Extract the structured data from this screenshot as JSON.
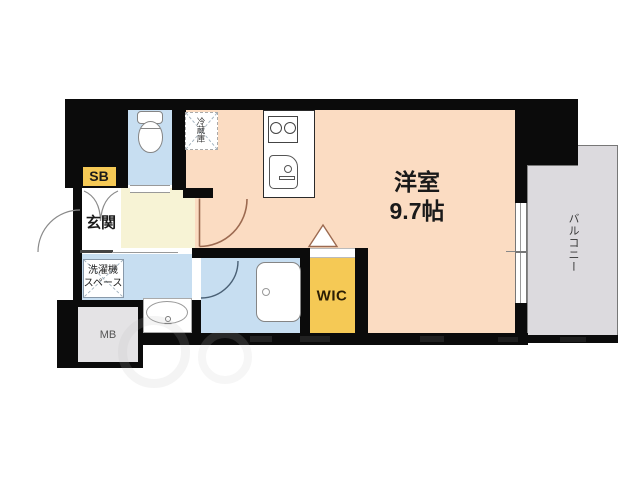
{
  "labels": {
    "main_room": {
      "name": "洋室",
      "size": "9.7帖"
    },
    "balcony": "バルコニー",
    "wic": "WIC",
    "genkan": "玄関",
    "shoe_box": "SB",
    "meter_box": "MB",
    "refrigerator": "冷蔵庫",
    "washer_line1": "洗濯機",
    "washer_line2": "スペース"
  },
  "colors": {
    "wall": "#0b0b0b",
    "room": "#fbdcc2",
    "hall": "#f7f3d5",
    "wet": "#c7def1",
    "yellow": "#f5c955",
    "balcony": "#dcdade",
    "mbfill": "#e4e3e5",
    "doorline": "#9c6a50",
    "graydoor": "#8a8a8a",
    "bathdoor": "#4a6075",
    "fixture": "#858585"
  }
}
